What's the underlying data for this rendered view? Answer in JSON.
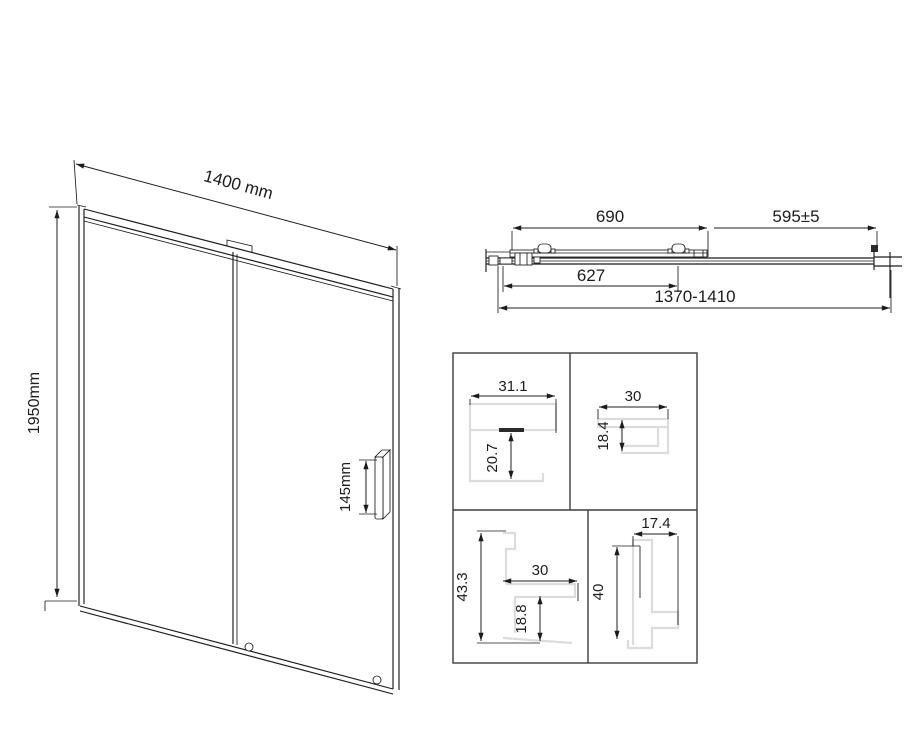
{
  "front_view": {
    "width_label": "1400 mm",
    "height_label": "1950mm",
    "handle_height_label": "145mm"
  },
  "top_view": {
    "door_panel_width": "690",
    "fixed_panel_width": "595±5",
    "glass_width": "627",
    "overall_width_range": "1370-1410"
  },
  "profile_details": {
    "top_left": {
      "width": "31.1",
      "depth": "20.7"
    },
    "top_right": {
      "width": "30",
      "depth": "18.4"
    },
    "bottom_left": {
      "height": "43.3",
      "width": "30",
      "depth": "18.8"
    },
    "bottom_right": {
      "width": "17.4",
      "height": "40"
    }
  },
  "colors": {
    "line": "#1c1c1c",
    "profile_outline": "#dcdcdc",
    "grid": "#3d3d3d",
    "background": "#ffffff"
  }
}
